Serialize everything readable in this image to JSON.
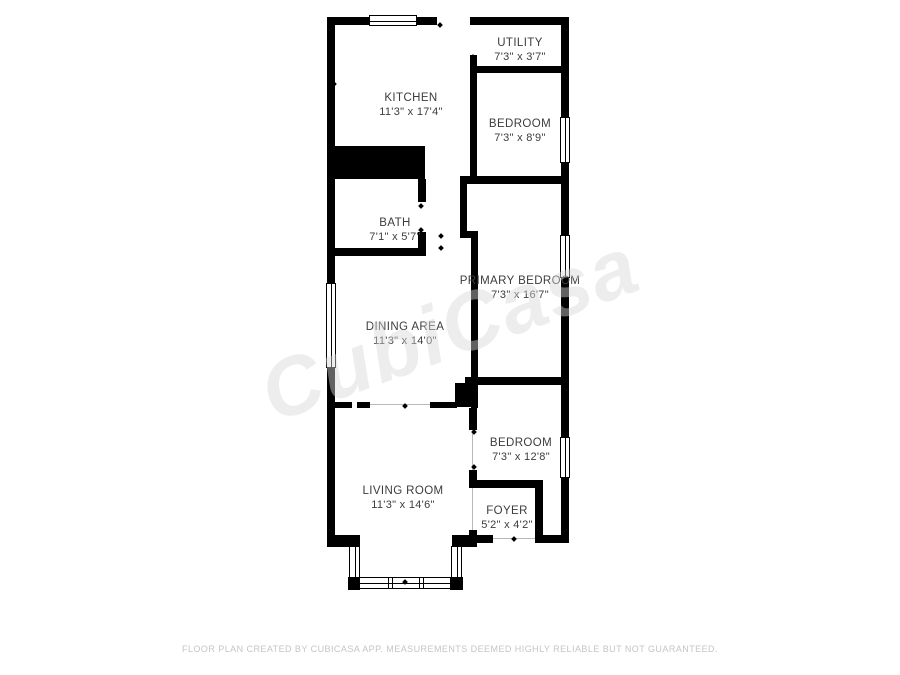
{
  "watermark": {
    "text": "CubiCasa"
  },
  "footer": {
    "disclaimer": "FLOOR PLAN CREATED BY CUBICASA APP. MEASUREMENTS DEEMED HIGHLY RELIABLE BUT NOT GUARANTEED."
  },
  "rooms": [
    {
      "name": "UTILITY",
      "dims": "7'3\" x 3'7\""
    },
    {
      "name": "KITCHEN",
      "dims": "11'3\" x 17'4\""
    },
    {
      "name": "BEDROOM",
      "dims": "7'3\" x 8'9\""
    },
    {
      "name": "BATH",
      "dims": "7'1\" x 5'7\""
    },
    {
      "name": "PRIMARY BEDROOM",
      "dims": "7'3\" x 16'7\""
    },
    {
      "name": "DINING AREA",
      "dims": "11'3\" x 14'0\""
    },
    {
      "name": "BEDROOM",
      "dims": "7'3\" x 12'8\""
    },
    {
      "name": "LIVING ROOM",
      "dims": "11'3\" x 14'6\""
    },
    {
      "name": "FOYER",
      "dims": "5'2\" x 4'2\""
    }
  ],
  "colors": {
    "wall": "#000000",
    "label": "#3c3c3c",
    "footer_text": "#c5c5c5"
  }
}
